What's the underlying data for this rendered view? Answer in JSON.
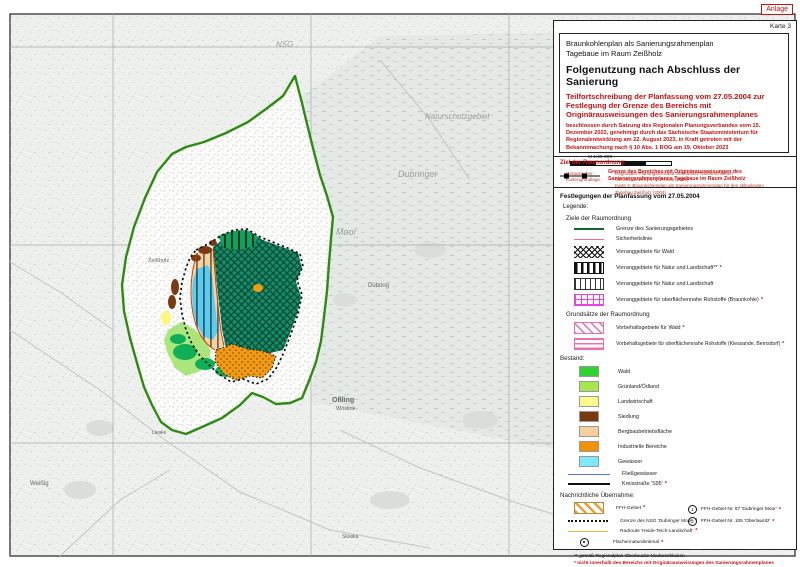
{
  "page": {
    "anlage_badge": "Anlage",
    "karte_label": "Karte 3"
  },
  "title_block": {
    "plan_line1": "Braunkohlenplan als Sanierungsrahmenplan",
    "plan_line2": "Tagebaue im Raum Zeißholz",
    "main_title": "Folgenutzung nach Abschluss der Sanierung",
    "subtitle": "Teilfortschreibung der Planfassung vom 27.05.2004 zur Festlegung der Grenze des Bereichs mit Originärausweisungen des Sanierungsrahmenplanes",
    "decision_note": "beschlossen durch Satzung des Regionalen Planungsverbandes vom 15. Dezember 2022, genehmigt durch das Sächsische Staatsministerium für Regionalentwicklung am 22. August 2023, in Kraft getreten mit der Bekanntmachung nach § 10 Abs. 1 ROG am 19. Oktober 2023",
    "scale_text": "M 1:25 000",
    "herausgeber_label": "Herausgeber:",
    "herausgeber_value": "Regionaler Planungsverband Oberlausitz-Niederschlesien",
    "kartengrundlage_label": "Kartengrundlage:",
    "kartengrundlage_value1": "GeoSN, dl-de/by-2-0, DTK25 (2019)",
    "kartengrundlage_value2": "Karte 3, Braunkohlenplan als Sanierungsrahmenplan für den stillgelegten Tagebau Zeißholz (2004)"
  },
  "ziel_section": {
    "heading": "Ziel der Raumordnung:",
    "item_label_line1": "Grenze des Bereiches mit Originärausweisungen des",
    "item_label_line2": "Sanierungsrahmenplanes Tagebaue im Raum Zeißholz"
  },
  "legend": {
    "festlegungen_heading": "Festlegungen der Planfassung vom 27.05.2004",
    "legende_label": "Legende:",
    "ziele_heading": "Ziele der Raumordnung",
    "ziele_rows": [
      {
        "label": "Grenze des Sanierungsgebietes",
        "marker": ""
      },
      {
        "label": "Sicherheitslinie",
        "marker": ""
      },
      {
        "label": "Vorranggebiete für Wald",
        "marker": ""
      },
      {
        "label": "Vorranggebiete für Natur und Landschaft**",
        "marker": "*"
      },
      {
        "label": "Vorranggebiete für Natur und Landschaft",
        "marker": ""
      },
      {
        "label": "Vorranggebiete für oberflächennahe Rohstoffe (Braunkohle)",
        "marker": "*"
      }
    ],
    "grundsaetze_heading": "Grundsätze der Raumordnung",
    "grundsaetze_rows": [
      {
        "label": "Vorbehaltsgebiete für Wald",
        "marker": "*"
      },
      {
        "label": "Vorbehaltsgebiete für oberflächennahe Rohstoffe (Kiessande, Bernsdorf)",
        "marker": "*"
      }
    ],
    "bestand_heading": "Bestand:",
    "bestand_rows": [
      {
        "label": "Wald",
        "color": "#2fd32f",
        "marker": ""
      },
      {
        "label": "Grünland/Ödland",
        "color": "#a8e64f",
        "marker": ""
      },
      {
        "label": "Landwirtschaft",
        "color": "#fdfb8a",
        "marker": ""
      },
      {
        "label": "Siedlung",
        "color": "#7a3a10",
        "marker": ""
      },
      {
        "label": "Bergbaubetriebsfläche",
        "color": "#f6cf9e",
        "marker": ""
      },
      {
        "label": "Industrielle Bereiche",
        "color": "#f29200",
        "marker": ""
      },
      {
        "label": "Gewässer",
        "color": "#7deafc",
        "marker": ""
      },
      {
        "label": "Fließgewässer",
        "color": "#5b6ff0",
        "marker": ""
      },
      {
        "label": "Kreisstraße 'S95'",
        "color": "#111111",
        "marker": "*"
      }
    ],
    "nachrichtlich_heading": "Nachrichtliche Übernahme:",
    "nachrichtlich_rows": [
      {
        "label": "FFH-Gebiet",
        "marker": "*"
      },
      {
        "label": "Grenze des NSG 'Dubringer Moor'",
        "marker": "*"
      },
      {
        "label": "Radroute 'Heide-Teich-Landschaft'",
        "marker": "*"
      },
      {
        "label": "Flächennaturdenkmal",
        "marker": "*"
      }
    ],
    "nachrichtlich_numbered": [
      {
        "num": "1",
        "label": "FFH-Gebiet Nr. 67 'Dubringer Moor'",
        "marker": "*"
      },
      {
        "num": "2",
        "label": "FFH-Gebiet Nr. 105 'Oberlausitz'",
        "marker": "*"
      }
    ],
    "footnote_black": "** gemäß Regionalplan Oberlausitz-Niederschlesien",
    "footnote_red": "* nicht innerhalb des Bereichs mit Originärausweisungen des Sanierungsrahmenplanes"
  },
  "map": {
    "labels": {
      "nsg": "NSG",
      "naturschutzgebiet": "Naturschutzgebiet",
      "dubringer": "Dubringer",
      "moor": "Moor",
      "zeissholz": "Zeißholz",
      "dubring": "Dubring",
      "ossling": "Oßling",
      "ossling_sorbian": "Wóslink",
      "lieske": "Lieske",
      "weissig": "Weißig",
      "skaska": "Skaska"
    },
    "colors": {
      "boundary_green": "#2e8b12",
      "red_accent": "#cc1111",
      "sicherheitslinie_red": "#cc3300",
      "vorrang_rohstoffe_magenta": "#e743e7",
      "vorbehalt_pink": "#f06eb0",
      "ffh_orange": "#e8a23a"
    }
  }
}
